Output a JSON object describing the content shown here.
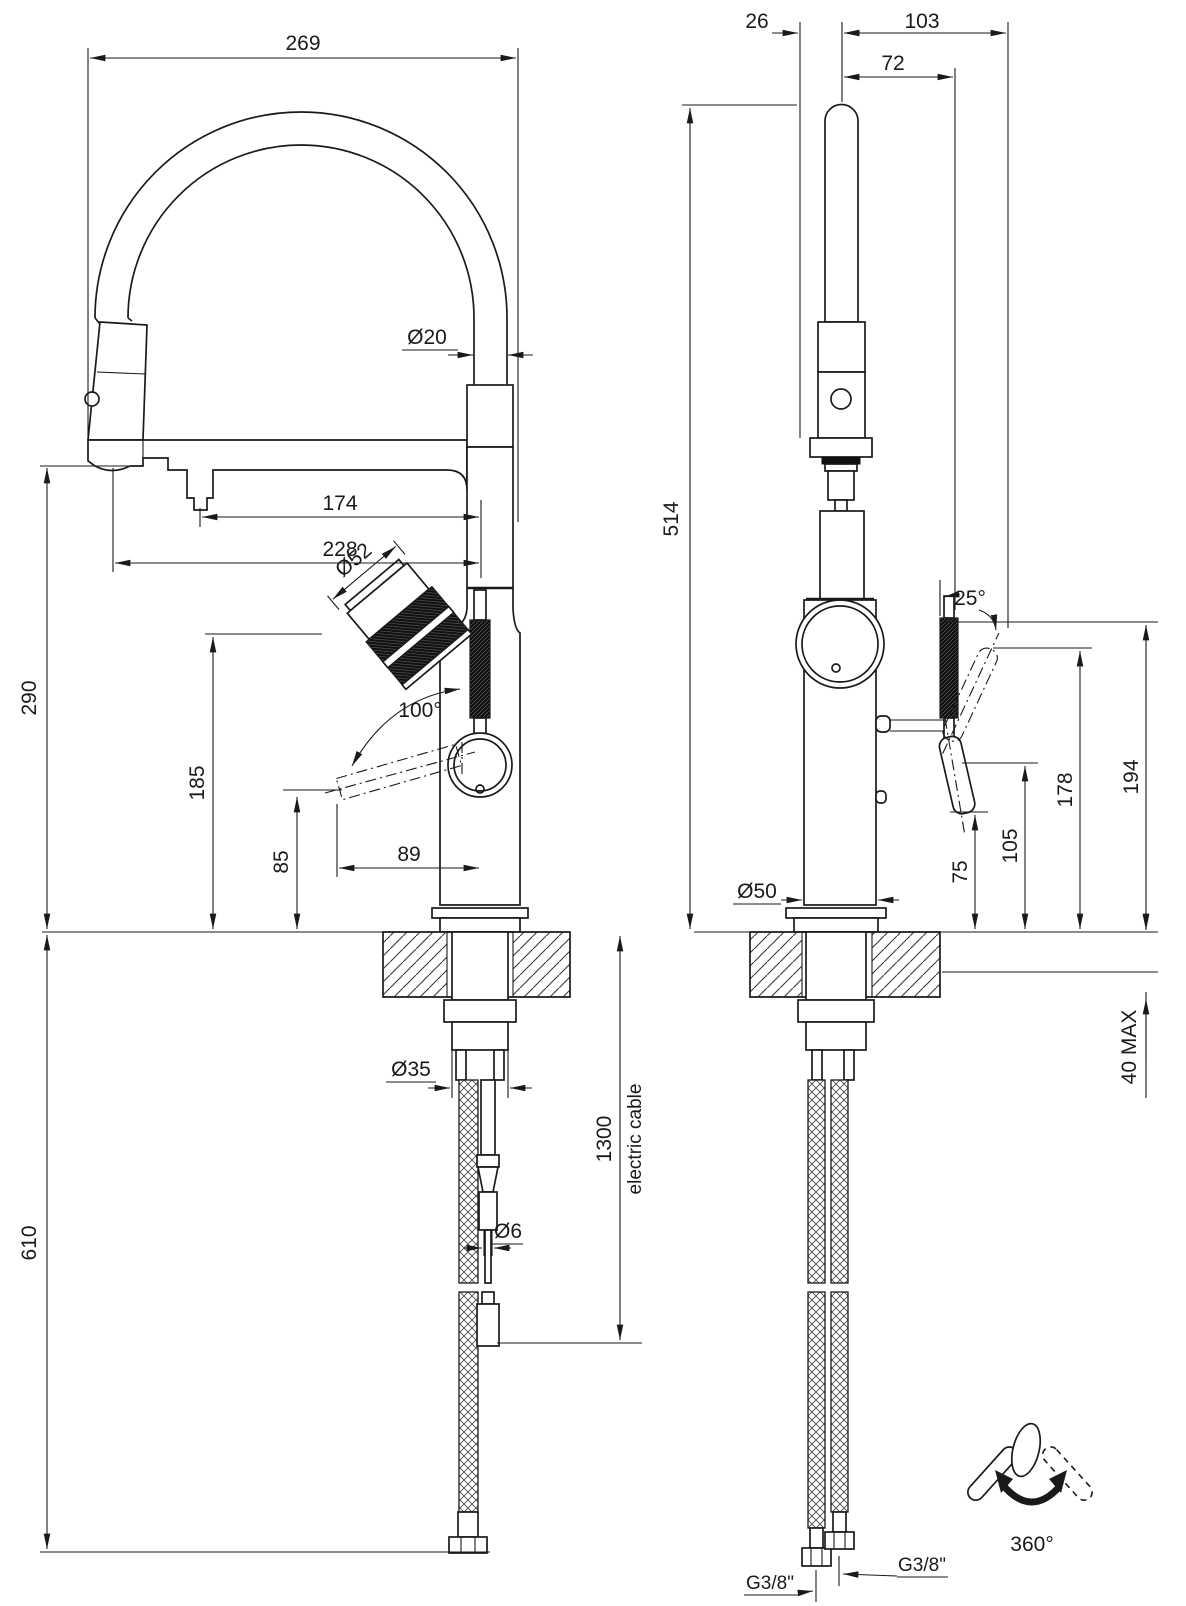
{
  "drawing": {
    "type": "technical-dimension-drawing",
    "subject": "kitchen mixer tap with pull-out spray, front and side installation views",
    "line_color": "#1a1a1a",
    "background": "#ffffff"
  },
  "dims": {
    "f269": "269",
    "fd20": "Ø20",
    "f174": "174",
    "f228": "228",
    "fd52": "Ø52",
    "f100": "100°",
    "f290": "290",
    "f185": "185",
    "f85": "85",
    "f89": "89",
    "f610": "610",
    "fd35": "Ø35",
    "f1300": "1300",
    "fcable": "electric cable",
    "fd6": "Ø6",
    "s26": "26",
    "s103": "103",
    "s72": "72",
    "s514": "514",
    "s25": "25°",
    "s194": "194",
    "s178": "178",
    "s105": "105",
    "s75": "75",
    "sd50": "Ø50",
    "s40max": "40 MAX",
    "gleft": "G3/8\"",
    "gright": "G3/8\"",
    "s360": "360°"
  }
}
